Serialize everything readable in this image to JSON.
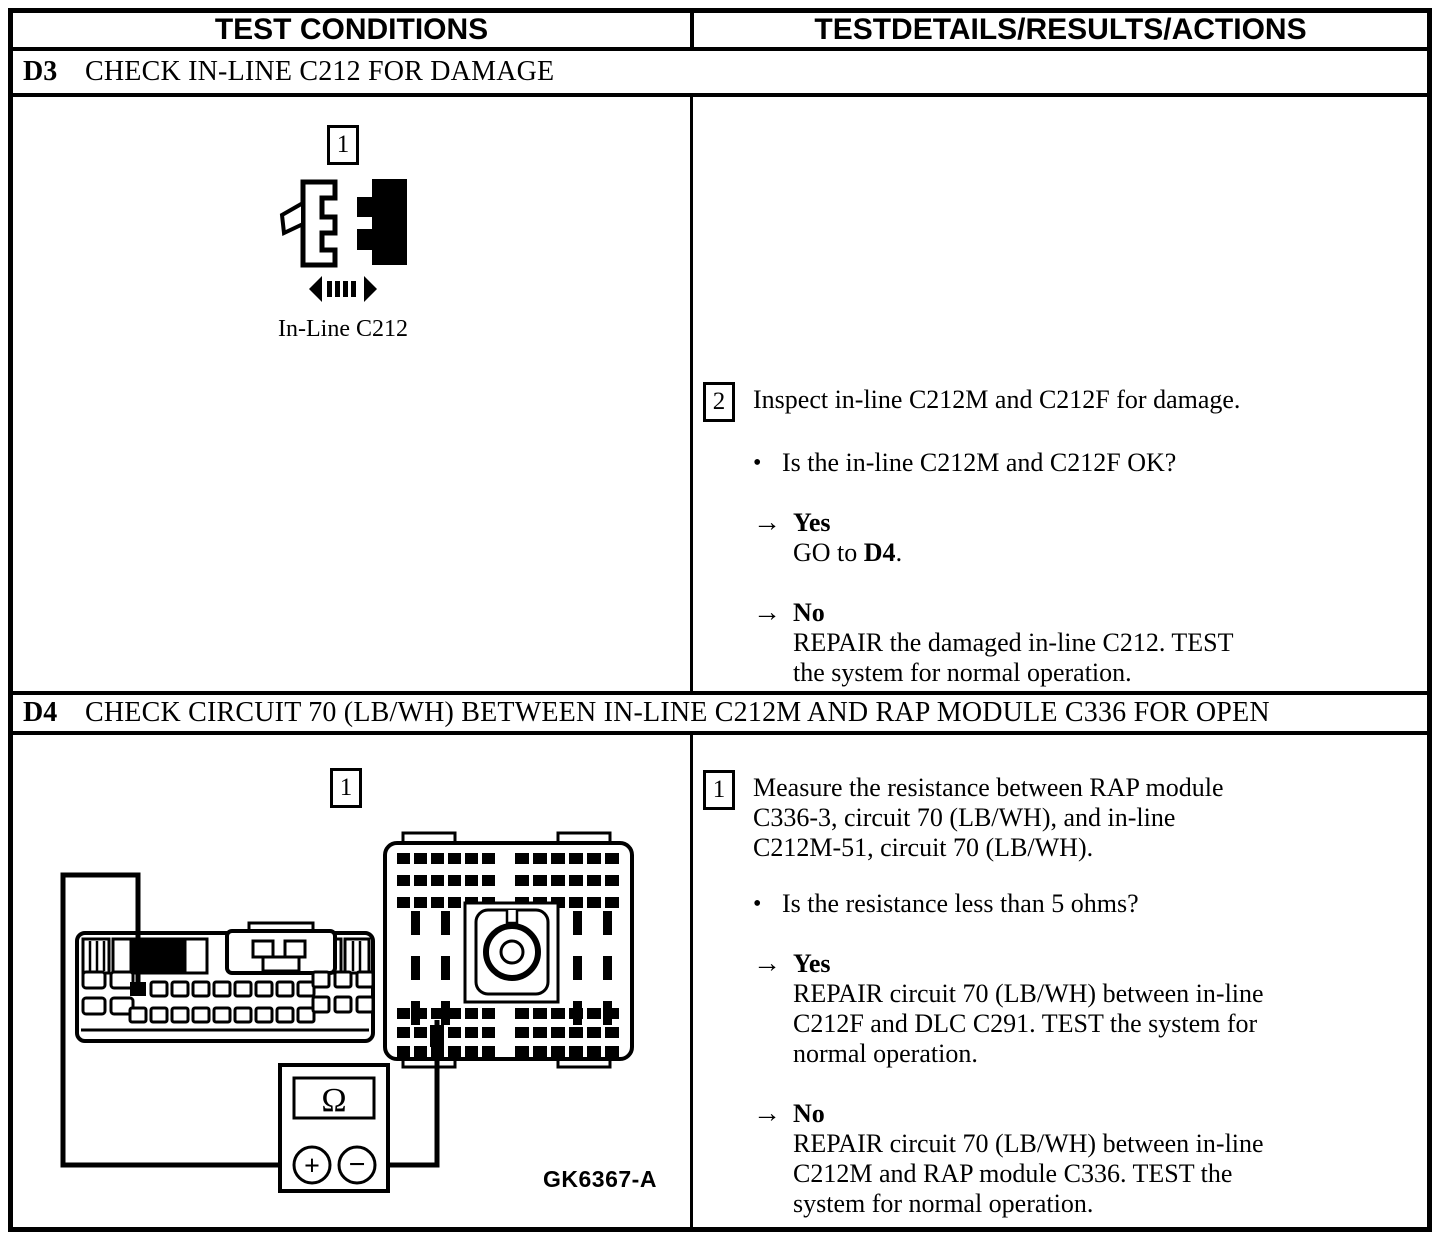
{
  "header": {
    "left": "TEST CONDITIONS",
    "right": "TESTDETAILS/RESULTS/ACTIONS"
  },
  "icons": {
    "arrow": "→",
    "bullet": "•"
  },
  "sections": [
    {
      "id": "D3",
      "title": "CHECK IN-LINE C212 FOR DAMAGE",
      "figure": {
        "step_number": "1",
        "caption": "In-Line C212"
      },
      "step": {
        "number": "2",
        "instruction": "Inspect in-line C212M and C212F for damage.",
        "question": "Is the in-line C212M and C212F OK?",
        "results": [
          {
            "answer": "Yes",
            "action_pre": "GO to ",
            "action_bold": "D4",
            "action_post": "."
          },
          {
            "answer": "No",
            "action": "REPAIR the damaged in-line C212. TEST\nthe system for normal operation."
          }
        ]
      }
    },
    {
      "id": "D4",
      "title": "CHECK CIRCUIT 70 (LB/WH) BETWEEN IN-LINE C212M AND RAP MODULE C336 FOR OPEN",
      "figure": {
        "step_number": "1",
        "figure_code": "GK6367-A",
        "meter_display": "Ω",
        "terminal_plus": "+",
        "terminal_minus": "−"
      },
      "step": {
        "number": "1",
        "instruction": "Measure the resistance between RAP module\nC336-3, circuit 70 (LB/WH), and in-line\nC212M-51, circuit 70 (LB/WH).",
        "question": "Is the resistance less than 5 ohms?",
        "results": [
          {
            "answer": "Yes",
            "action": "REPAIR circuit 70 (LB/WH) between in-line\nC212F and DLC C291. TEST the system for\nnormal operation."
          },
          {
            "answer": "No",
            "action": "REPAIR circuit 70 (LB/WH) between in-line\nC212M and RAP module C336. TEST the\nsystem for normal operation."
          }
        ]
      }
    }
  ]
}
